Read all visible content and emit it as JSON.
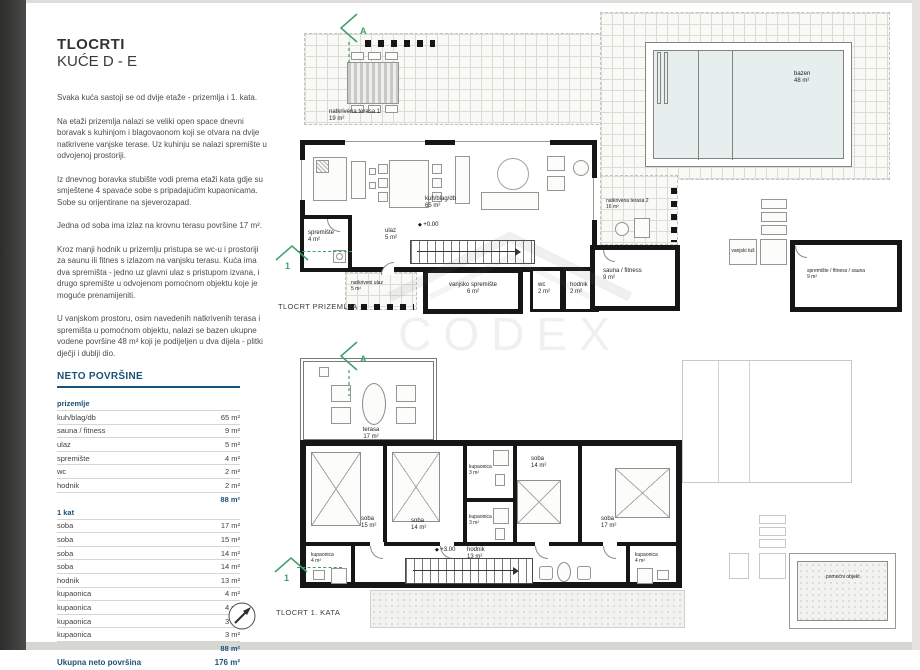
{
  "doc": {
    "title_line1": "TLOCRTI",
    "title_line2": "KUĆE D - E",
    "paragraphs": [
      "Svaka kuća sastoji se od dvije etaže - prizemlja i 1. kata.",
      "Na etaži prizemlja nalazi se veliki open space dnevni boravak s kuhinjom i blagovaonom koji se otvara na dvije natkrivene vanjske terase. Uz kuhinju se nalazi spremište u odvojenoj prostoriji.",
      "Iz dnevnog boravka stubište vodi prema etaži kata gdje su smještene 4 spavaće sobe s pripadajućim kupaonicama. Sobe su orijentirane na sjeverozapad.",
      "Jedna od soba ima izlaz na krovnu terasu površine 17 m².",
      "Kroz manji hodnik u prizemlju pristupa se wc-u i prostoriji za saunu ili fitnes s izlazom na vanjsku terasu. Kuća ima dva spremišta - jedno uz glavni ulaz s pristupom izvana, i drugo spremište u odvojenom pomoćnom objektu koje je moguće prenamijeniti.",
      "U vanjskom prostoru, osim navedenih natkrivenih terasa i spremišta u pomoćnom objektu, nalazi se bazen ukupne vodene površine 48 m² koji je podijeljen u dva dijela - plitki dječji i dublji dio."
    ],
    "watermark": "CODEX"
  },
  "areas": {
    "heading": "NETO POVRŠINE",
    "sections": [
      {
        "label": "prizemlje",
        "rows": [
          [
            "kuh/blag/db",
            "65 m²"
          ],
          [
            "sauna / fitness",
            "9 m²"
          ],
          [
            "ulaz",
            "5 m²"
          ],
          [
            "spremište",
            "4 m²"
          ],
          [
            "wc",
            "2 m²"
          ],
          [
            "hodnik",
            "2 m²"
          ]
        ],
        "subtotal": "88 m²"
      },
      {
        "label": "1 kat",
        "rows": [
          [
            "soba",
            "17 m²"
          ],
          [
            "soba",
            "15 m²"
          ],
          [
            "soba",
            "14 m²"
          ],
          [
            "soba",
            "14 m²"
          ],
          [
            "hodnik",
            "13 m²"
          ],
          [
            "kupaonica",
            "4 m²"
          ],
          [
            "kupaonica",
            "4 m²"
          ],
          [
            "kupaonica",
            "3 m²"
          ],
          [
            "kupaonica",
            "3 m²"
          ]
        ],
        "subtotal": "88 m²"
      }
    ],
    "total_label": "Ukupna neto površina",
    "total_value": "176 m²"
  },
  "markers": {
    "section_a": "A",
    "section_1": "1"
  },
  "ground": {
    "caption": "TLOCRT PRIZEMLJA",
    "elevation": "+0.00",
    "rooms": {
      "terasa1": {
        "name": "natkrivena terasa 1",
        "area": "19 m²"
      },
      "bazen": {
        "name": "bazen",
        "area": "48 m²"
      },
      "kuh": {
        "name": "kuh/blag/db",
        "area": "65 m²"
      },
      "ulaz": {
        "name": "ulaz",
        "area": "5 m²"
      },
      "spremiste": {
        "name": "spremište",
        "area": "4 m²"
      },
      "natkriveni_ulaz": {
        "name": "natkriveni ulaz",
        "area": "5 m²"
      },
      "vanjsko_spremiste": {
        "name": "vanjsko spremište",
        "area": "6 m²"
      },
      "wc": {
        "name": "wc",
        "area": "2 m²"
      },
      "hodnik": {
        "name": "hodnik",
        "area": "2 m²"
      },
      "terasa2": {
        "name": "natkrivena terasa 2",
        "area": "16 m²"
      },
      "sauna": {
        "name": "sauna / fitness",
        "area": "9 m²"
      },
      "tus": {
        "name": "vanjski tuš"
      },
      "pomocni": {
        "name": "spremište / fitness / sauna",
        "area": "9 m²"
      }
    }
  },
  "first": {
    "caption": "TLOCRT 1. KATA",
    "elevation": "+3.00",
    "rooms": {
      "terasa": {
        "name": "terasa",
        "area": "17 m²"
      },
      "soba1": {
        "name": "soba",
        "area": "15 m²"
      },
      "soba2": {
        "name": "soba",
        "area": "14 m²"
      },
      "soba3": {
        "name": "soba",
        "area": "14 m²"
      },
      "soba4": {
        "name": "soba",
        "area": "17 m²"
      },
      "kup_top": {
        "name": "kupaonica",
        "area": "3 m²"
      },
      "kup_mid": {
        "name": "kupaonica",
        "area": "3 m²"
      },
      "kup_left": {
        "name": "kupaonica",
        "area": "4 m²"
      },
      "kup_right": {
        "name": "kupaonica",
        "area": "4 m²"
      },
      "hodnik": {
        "name": "hodnik",
        "area": "13 m²"
      },
      "pomocni": {
        "name": "pomoćni objekt"
      }
    }
  }
}
